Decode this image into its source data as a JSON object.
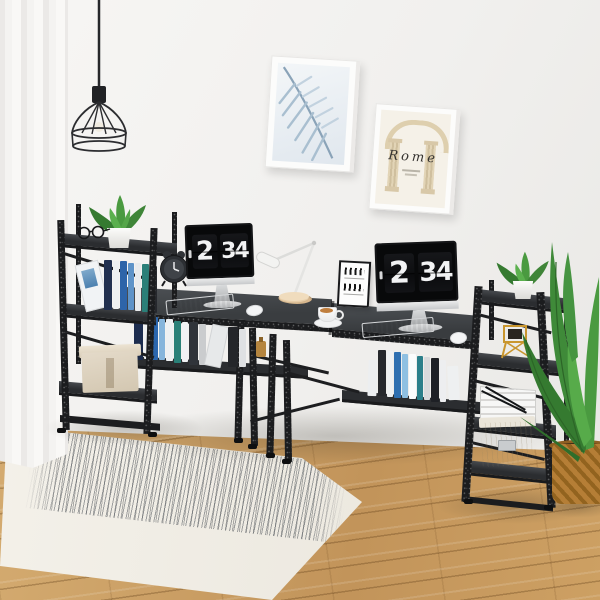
{
  "scene": {
    "description": "Product photo: black two-person computer desk with end tower shelves in a bright home office",
    "setting": "white wall, sheer curtain, oak floor, striped rug"
  },
  "wall_art": {
    "palm_frame": "blue palm leaf print",
    "rome_frame_title": "Rome"
  },
  "monitors": {
    "left": {
      "hour": "2",
      "minute": "34"
    },
    "right": {
      "hour": "2",
      "minute": "34"
    }
  },
  "colors": {
    "wall": "#f2f1ef",
    "floor_wood": "#c79b60",
    "desk_top": "#3f4347",
    "metal_frame": "#1b1c1e",
    "rug": "#f2efe9",
    "rug_stripes": "#5d6268",
    "plant_green": "#4a9a40",
    "gold_decor": "#c9962e",
    "wicker_basket": "#a06c26",
    "storage_box": "#ddd3c2",
    "book_blue": "#2e6fb0"
  }
}
